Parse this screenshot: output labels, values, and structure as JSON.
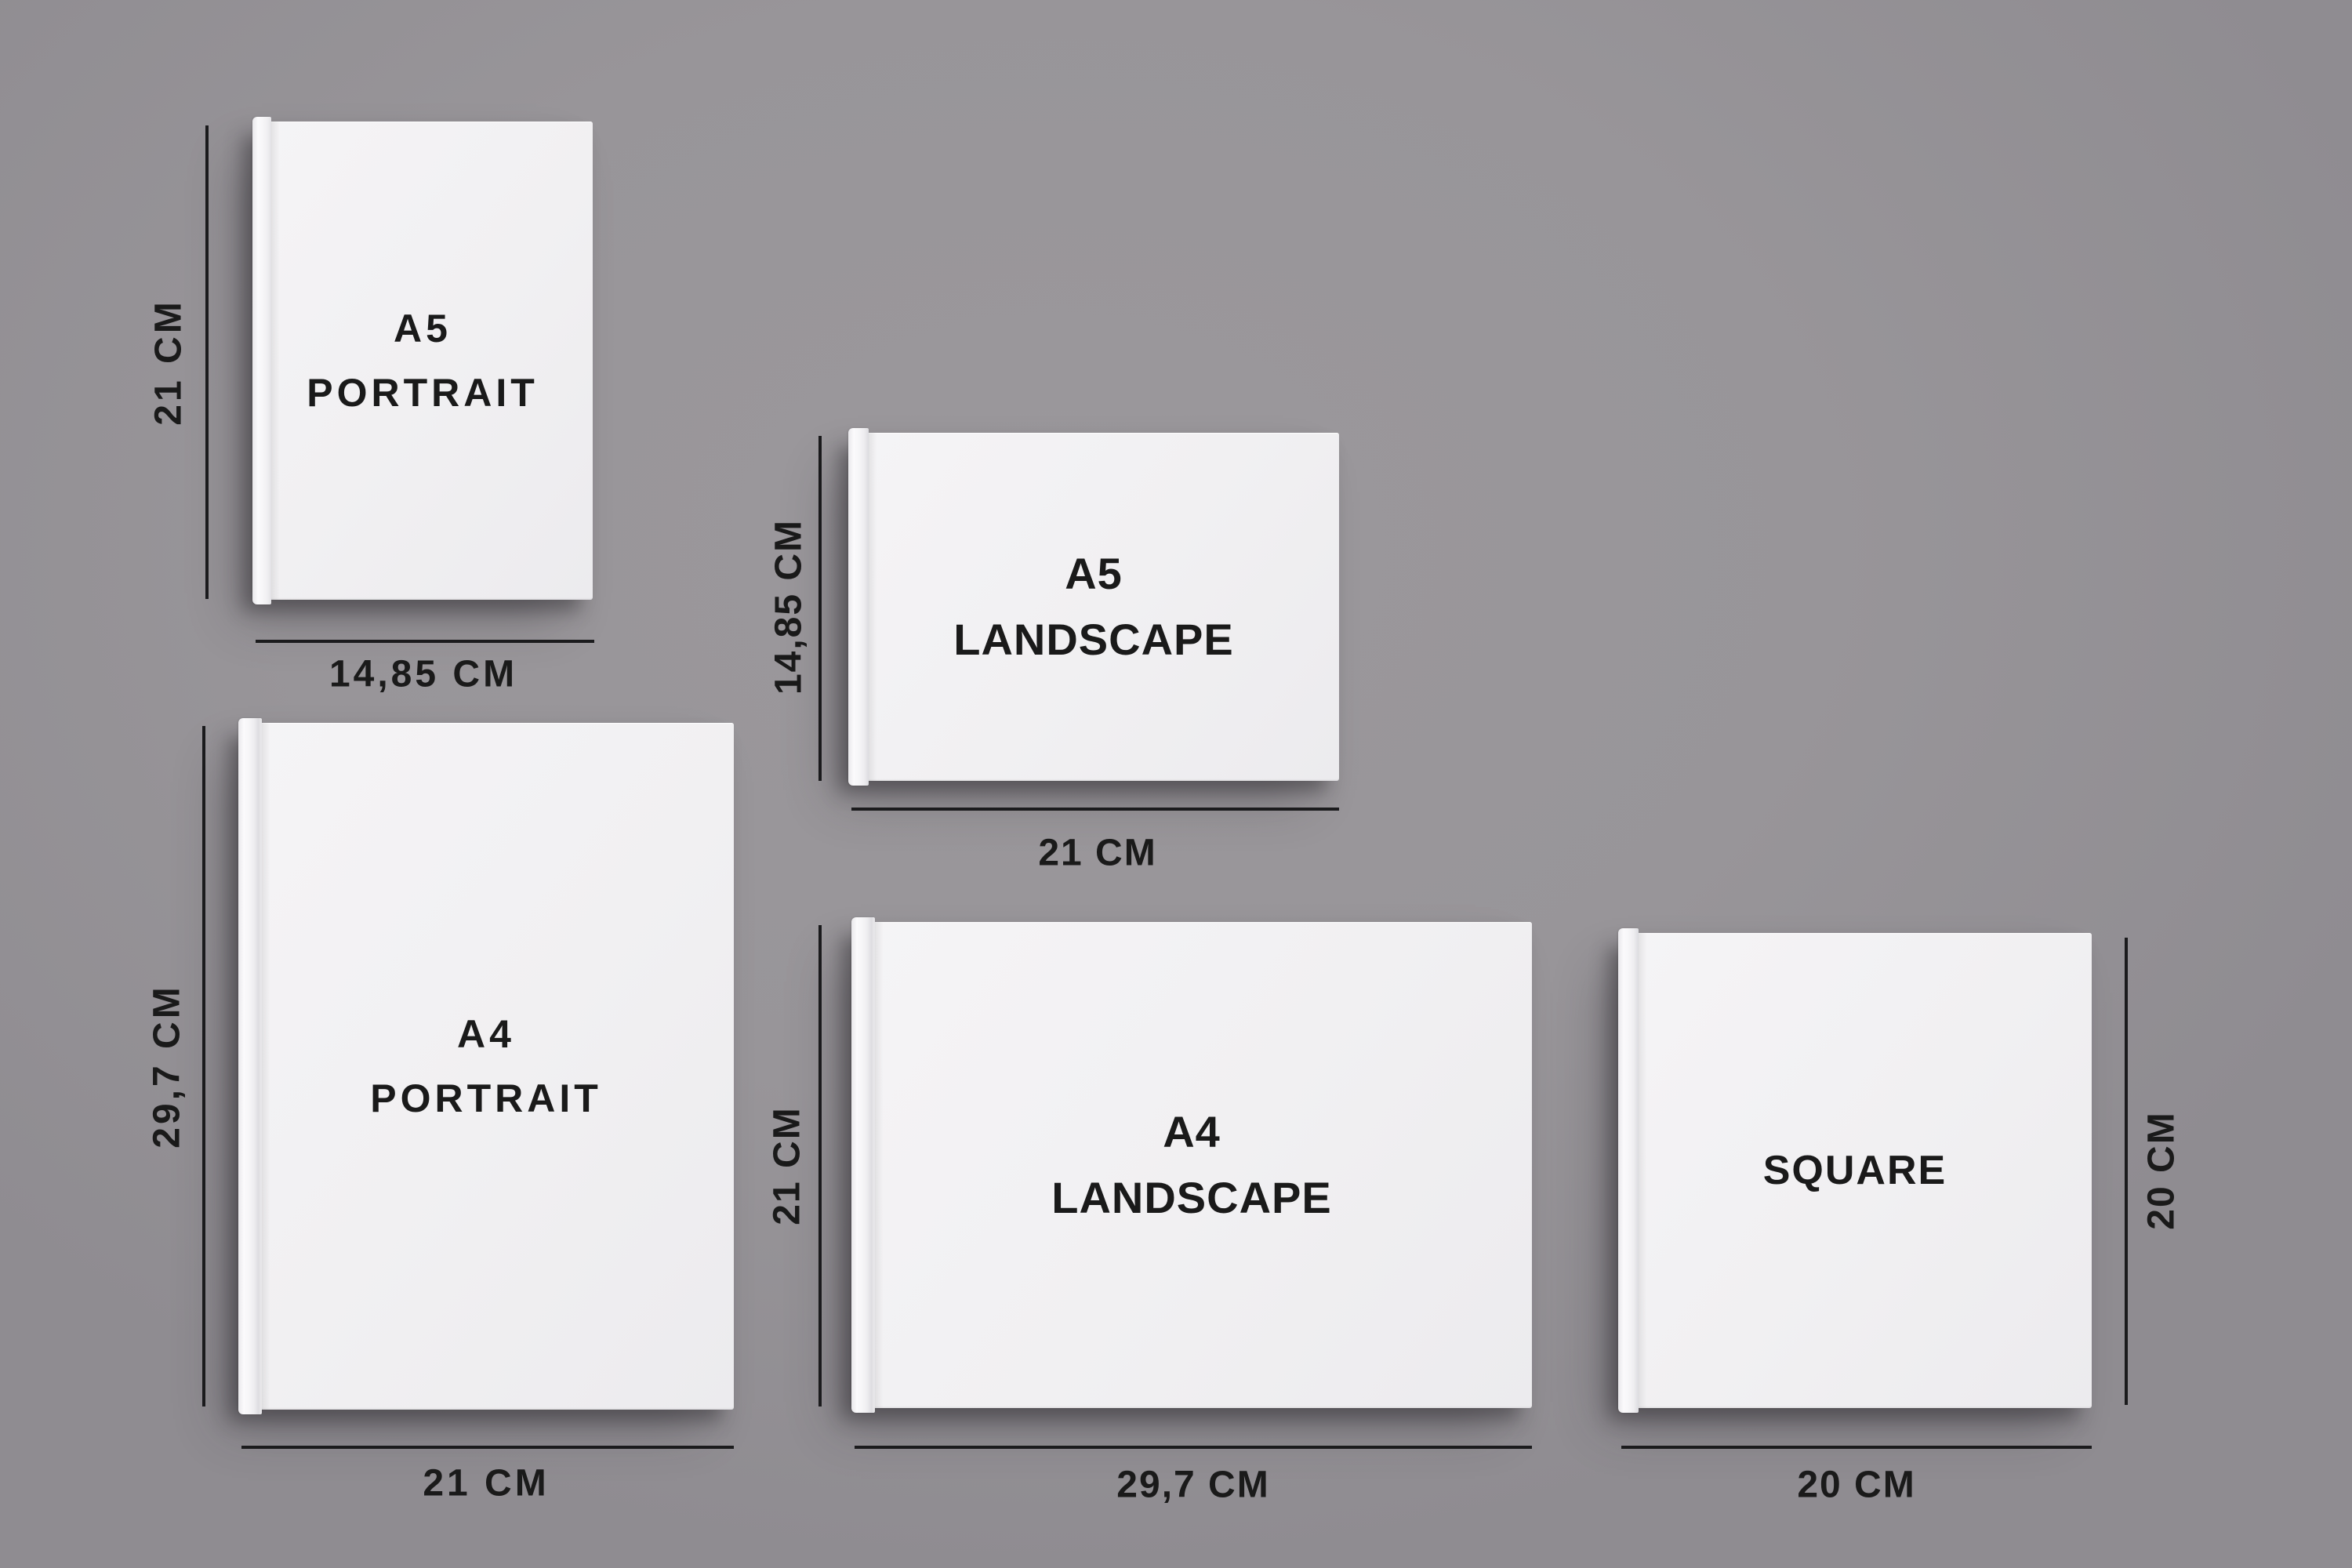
{
  "diagram": {
    "description": "Photo book size comparison mockup",
    "unit": "CM",
    "background_color": "#989599",
    "line_color": "#1b1b1d",
    "text_color": "#1a1a1a",
    "cover_color": "#f1f0f2"
  },
  "books": [
    {
      "name": "A5 Portrait",
      "title_line1": "A5",
      "title_line2": "PORTRAIT",
      "height_label": "21 CM",
      "width_label": "14,85 CM",
      "height_cm": 21,
      "width_cm": 14.85
    },
    {
      "name": "A5 Landscape",
      "title_line1": "A5",
      "title_line2": "LANDSCAPE",
      "height_label": "14,85 CM",
      "width_label": "21 CM",
      "height_cm": 14.85,
      "width_cm": 21
    },
    {
      "name": "A4 Portrait",
      "title_line1": "A4",
      "title_line2": "PORTRAIT",
      "height_label": "29,7 CM",
      "width_label": "21 CM",
      "height_cm": 29.7,
      "width_cm": 21
    },
    {
      "name": "A4 Landscape",
      "title_line1": "A4",
      "title_line2": "LANDSCAPE",
      "height_label": "21 CM",
      "width_label": "29,7 CM",
      "height_cm": 21,
      "width_cm": 29.7
    },
    {
      "name": "Square",
      "title_line1": "SQUARE",
      "title_line2": "",
      "height_label": "20 CM",
      "width_label": "20 CM",
      "height_cm": 20,
      "width_cm": 20
    }
  ]
}
